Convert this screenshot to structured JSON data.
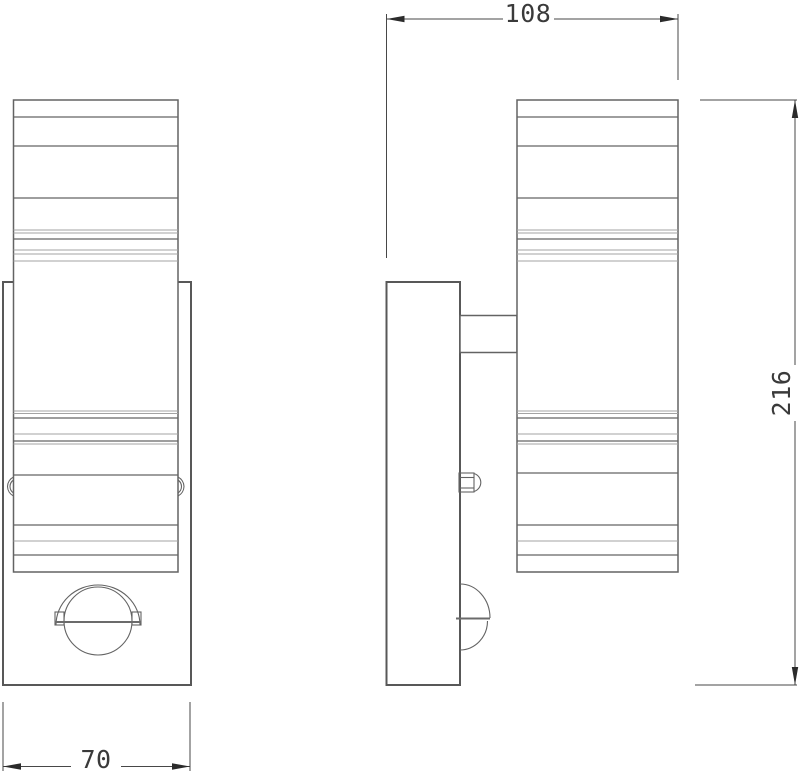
{
  "drawing": {
    "title": "wall-light-two-view-technical-drawing",
    "dimensions": {
      "top_width": "108",
      "right_height": "216",
      "bottom_width": "70"
    },
    "colors": {
      "line_main": "#636363",
      "line_thin": "#a3a3a3",
      "line_dim": "#474747",
      "ink": "#2b2b2b",
      "background": "#ffffff"
    }
  }
}
